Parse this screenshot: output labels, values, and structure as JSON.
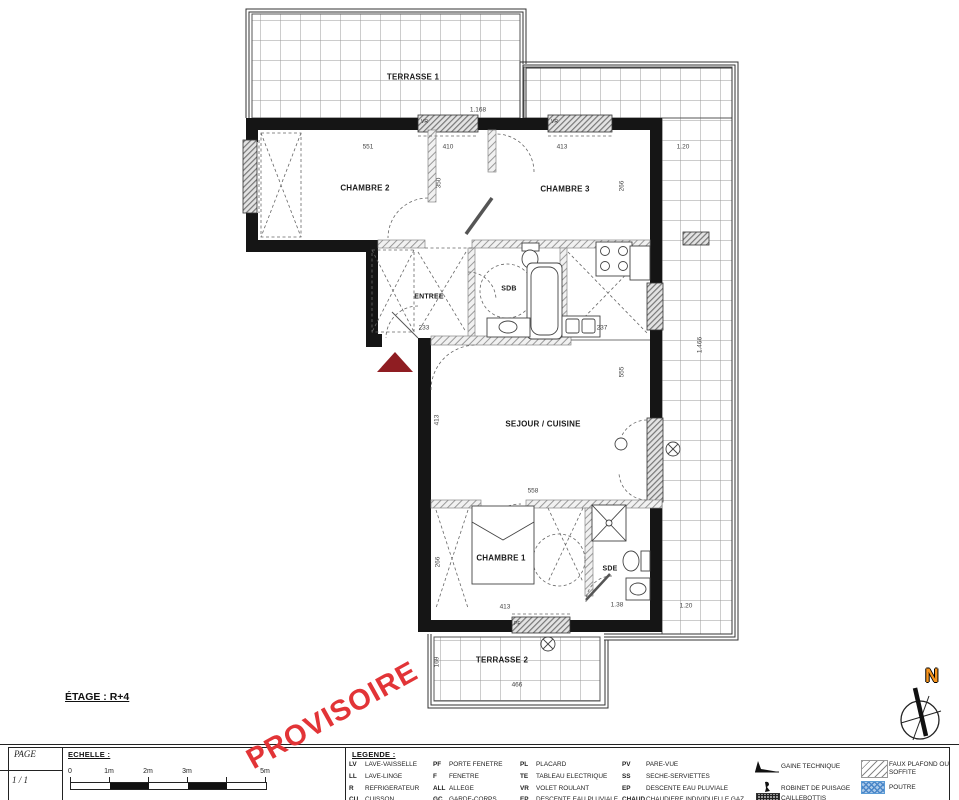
{
  "sheet": {
    "floor_label": "ÉTAGE : R+4",
    "watermark": "PROVISOIRE",
    "north_label": "N"
  },
  "plan": {
    "rooms": {
      "terrasse1": "TERRASSE 1",
      "chambre2": "CHAMBRE 2",
      "chambre3": "CHAMBRE 3",
      "entree": "ENTREE",
      "sdb": "SDB",
      "sejour_cuisine": "SEJOUR / CUISINE",
      "chambre1": "CHAMBRE 1",
      "sde": "SDE",
      "terrasse2": "TERRASSE 2"
    },
    "dimensions": [
      "551",
      "410",
      "413",
      "1.20",
      "350",
      "266",
      "233",
      "237",
      "558",
      "413",
      "555",
      "413",
      "1.38",
      "266",
      "466",
      "169",
      "1.20",
      "1.168",
      "1.466"
    ],
    "window_labels": [
      "VR",
      "VR",
      "PF"
    ]
  },
  "titleblock": {
    "page_label": "PAGE",
    "page_value": "1 / 1",
    "scale": {
      "label": "ECHELLE :",
      "ticks": [
        "0",
        "1m",
        "2m",
        "3m",
        "5m"
      ]
    },
    "legend": {
      "title": "LEGENDE :",
      "columns": [
        {
          "items": [
            {
              "abbr": "LV",
              "label": "LAVE-VAISSELLE"
            },
            {
              "abbr": "LL",
              "label": "LAVE-LINGE"
            },
            {
              "abbr": "R",
              "label": "REFRIGERATEUR"
            },
            {
              "abbr": "CU",
              "label": "CUISSON"
            }
          ]
        },
        {
          "items": [
            {
              "abbr": "PF",
              "label": "PORTE FENETRE"
            },
            {
              "abbr": "F",
              "label": "FENETRE"
            },
            {
              "abbr": "ALL",
              "label": "ALLEGE"
            },
            {
              "abbr": "GC",
              "label": "GARDE-CORPS"
            }
          ]
        },
        {
          "items": [
            {
              "abbr": "PL",
              "label": "PLACARD"
            },
            {
              "abbr": "TE",
              "label": "TABLEAU ELECTRIQUE"
            },
            {
              "abbr": "VR",
              "label": "VOLET ROULANT"
            },
            {
              "abbr": "EP",
              "label": "DESCENTE EAU PLUVIALE"
            }
          ]
        },
        {
          "items": [
            {
              "abbr": "PV",
              "label": "PARE-VUE"
            },
            {
              "abbr": "SS",
              "label": "SECHE-SERVIETTES"
            },
            {
              "abbr": "EP",
              "label": "DESCENTE EAU PLUVIALE"
            },
            {
              "abbr": "CHAUD",
              "label": "CHAUDIERE INDIVIDUELLE GAZ"
            }
          ]
        }
      ],
      "symbols": [
        {
          "name": "gaine-technique",
          "label": "GAINE TECHNIQUE"
        },
        {
          "name": "robinet-de-puisage",
          "label": "ROBINET DE PUISAGE"
        },
        {
          "name": "caillebottis",
          "label": "CAILLEBOTTIS"
        }
      ],
      "hatches": [
        {
          "name": "faux-plafond",
          "label": "FAUX PLAFOND OU SOFFITE"
        },
        {
          "name": "poutre",
          "label": "POUTRE"
        }
      ]
    }
  },
  "colors": {
    "watermark_red": "#e23437",
    "entry_arrow_red": "#8f1d22",
    "north_orange": "#f7941d",
    "poutre_blue": "#5b9bd5",
    "line_black": "#1a1a1a"
  }
}
